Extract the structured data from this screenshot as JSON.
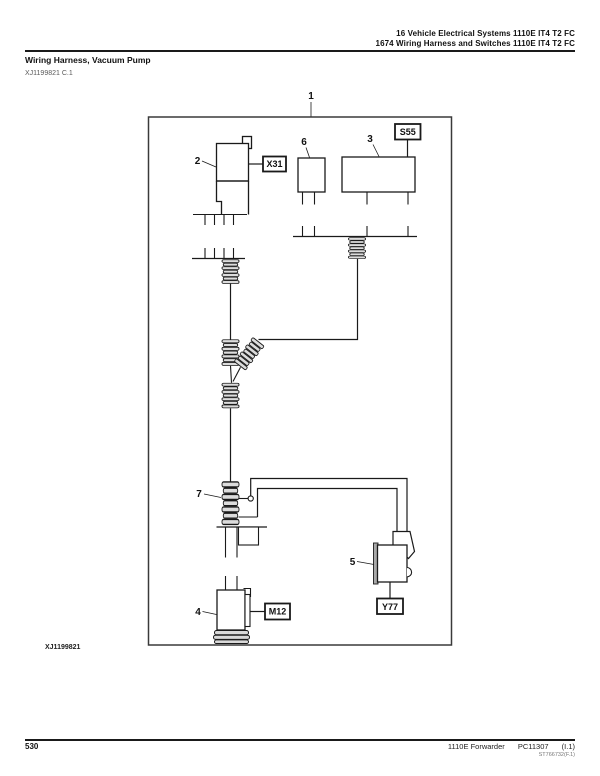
{
  "header": {
    "line1": "16 Vehicle Electrical Systems 1110E IT4 T2 FC",
    "line2": "1674 Wiring Harness and Switches 1110E IT4 T2 FC"
  },
  "title": "Wiring Harness, Vacuum Pump",
  "figure_reference": "XJ1199821 C.1",
  "diagram": {
    "ink_color": "#1a1a1a",
    "callouts": {
      "c1": "1",
      "c2": "2",
      "c3": "3",
      "c4": "4",
      "c5": "5",
      "c6": "6",
      "c7": "7"
    },
    "connector_tags": {
      "x31": "X31",
      "s55": "S55",
      "m12": "M12",
      "y77": "Y77"
    },
    "caption": "XJ1199821"
  },
  "footer": {
    "page_number": "530",
    "model": "1110E Forwarder",
    "manual_code": "PC11307",
    "revision": "(I.1)",
    "doc_code": "ST766732(F.1)"
  }
}
